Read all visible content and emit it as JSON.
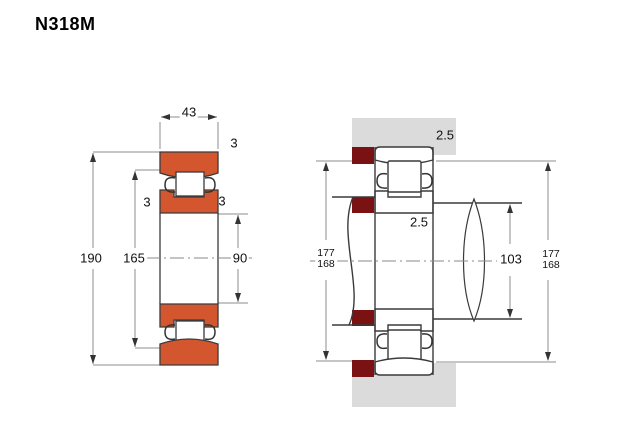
{
  "title": "N318M",
  "colors": {
    "ring_orange": "#d4562f",
    "shoulder_maroon": "#7a1113",
    "housing_gray": "#dbdbdb",
    "outline": "#3a3a3a",
    "dim_line": "#8c8c8c"
  },
  "cross_section_view": {
    "width_label": "43",
    "outer_diameter_label": "190",
    "shoulder_diameter_label": "165",
    "bore_diameter_label": "90",
    "chamfer_top_label": "3",
    "chamfer_left_label": "3",
    "chamfer_right_label": "3"
  },
  "mounting_view": {
    "housing_fillet_label": "2.5",
    "shaft_fillet_label": "2.5",
    "left_abutment_top_label": "177",
    "left_abutment_bottom_label": "168",
    "shaft_abutment_label": "103",
    "right_abutment_top_label": "177",
    "right_abutment_bottom_label": "168"
  }
}
